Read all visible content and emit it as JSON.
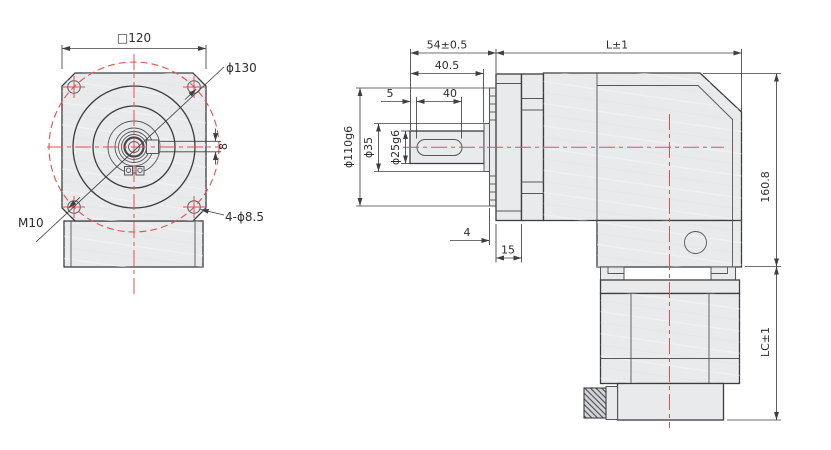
{
  "drawing": {
    "type": "right-angle planetary gearbox dimension drawing",
    "colors": {
      "part_fill": "#e9eaec",
      "outline": "#3d3d40",
      "centerline_red": "#e05252",
      "dimension": "#2e2e30"
    }
  },
  "front_view": {
    "square": "□120",
    "bolt_circle": "ϕ130",
    "keyway_width": "8",
    "thread": "M10",
    "corner_holes": "4-ϕ8.5"
  },
  "side_view": {
    "shaft_to_flange": "54±0.5",
    "body_length": "L±1",
    "shaft_step": "40.5",
    "key_offset": "5",
    "key_length": "40",
    "pilot_dia": "ϕ110g6",
    "shoulder_dia": "ϕ35",
    "shaft_dia": "ϕ25g6",
    "boss_depth": "4",
    "flange_thickness": "15",
    "body_height": "160.8",
    "motor_length": "LC±1"
  }
}
